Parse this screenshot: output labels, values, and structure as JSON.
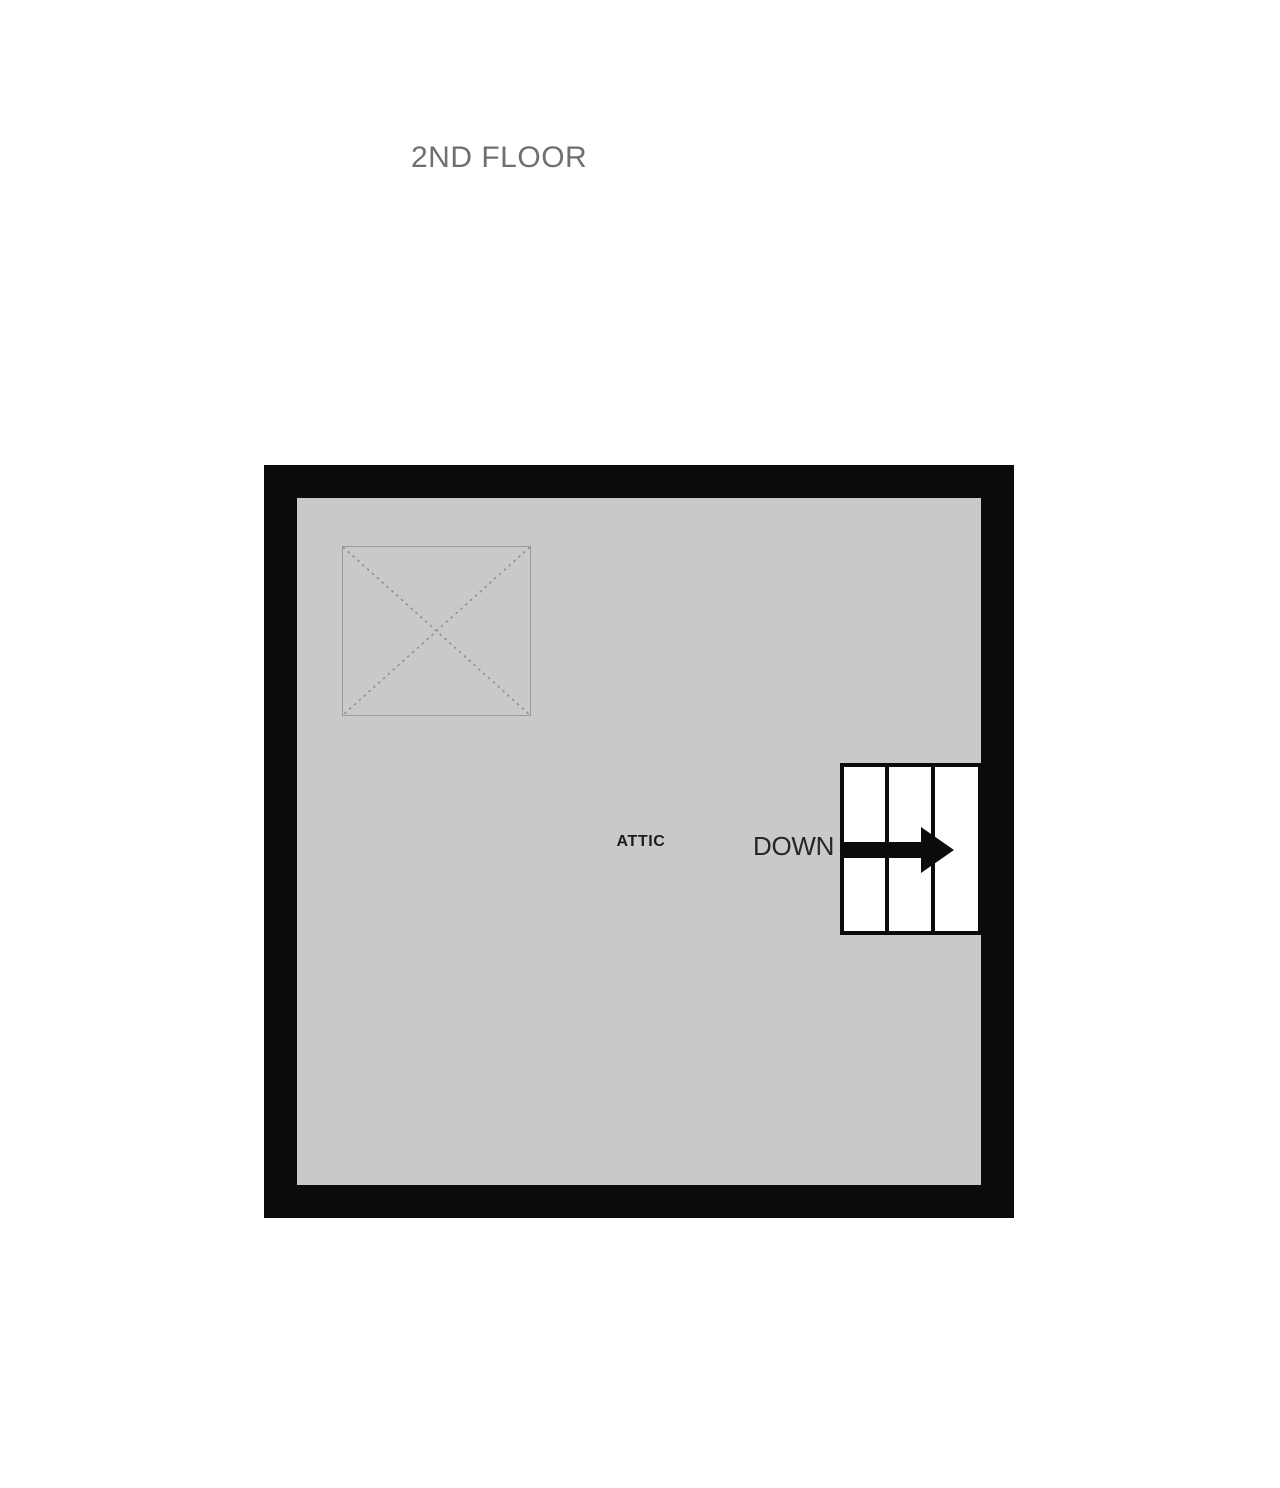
{
  "page": {
    "title": "2ND FLOOR"
  },
  "floor_plan": {
    "room_label": "ATTIC",
    "stairs": {
      "label": "DOWN",
      "direction": "right",
      "tread_count": 3
    },
    "symbols": {
      "crossed_box_icon": "dashed-x-square (open area / shaft symbol)",
      "down_arrow_icon": "solid right arrow"
    }
  },
  "colors": {
    "page_bg": "#ffffff",
    "title_text": "#6f6f6f",
    "wall": "#0b0b0b",
    "floor": "#c9c9c9",
    "room_text": "#1c1c1c",
    "stair_text": "#262626",
    "stair_fill": "#ffffff",
    "crossed_box_line": "#8f8f8f"
  }
}
